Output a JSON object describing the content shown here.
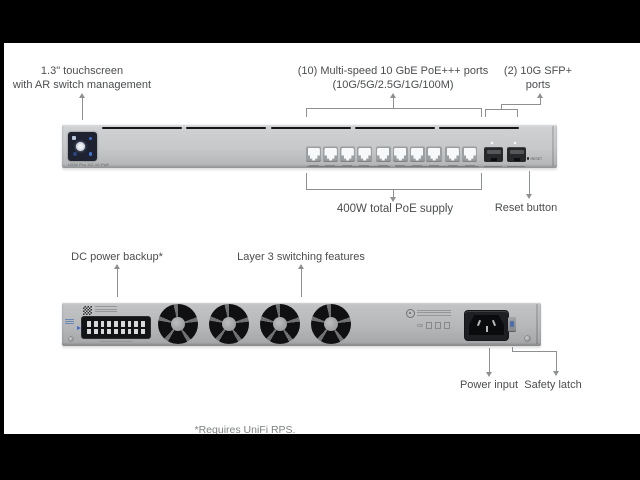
{
  "page": {
    "background": "#ffffff",
    "letterbox_color": "#000000",
    "footnote": "*Requires UniFi RPS.",
    "line_color": "#8e9092",
    "label_color": "#4b4d4f"
  },
  "front_view": {
    "labels": {
      "touchscreen_line1": "1.3\" touchscreen",
      "touchscreen_line2": "with AR switch management",
      "poe_line1": "(10) Multi-speed 10 GbE PoE+++ ports",
      "poe_line2": "(10G/5G/2.5G/1G/100M)",
      "sfp_line1": "(2) 10G SFP+",
      "sfp_line2": "ports",
      "poe_supply": "400W total PoE supply",
      "reset": "Reset button"
    },
    "device": {
      "model_label": "USW Pro XG 10 PoE",
      "reset_label": "RESET",
      "vent_slots": 5,
      "rj45_groups": [
        4,
        4,
        2
      ],
      "sfp_count": 2,
      "screen_accent": "#3f74d2"
    }
  },
  "rear_view": {
    "labels": {
      "dc_backup": "DC power backup*",
      "layer3": "Layer 3 switching features",
      "power_input": "Power input",
      "safety_latch": "Safety latch"
    },
    "device": {
      "fan_count": 4,
      "dc_pin_rows": 2,
      "dc_pins_per_row": 9,
      "cert_text": "CE"
    }
  }
}
